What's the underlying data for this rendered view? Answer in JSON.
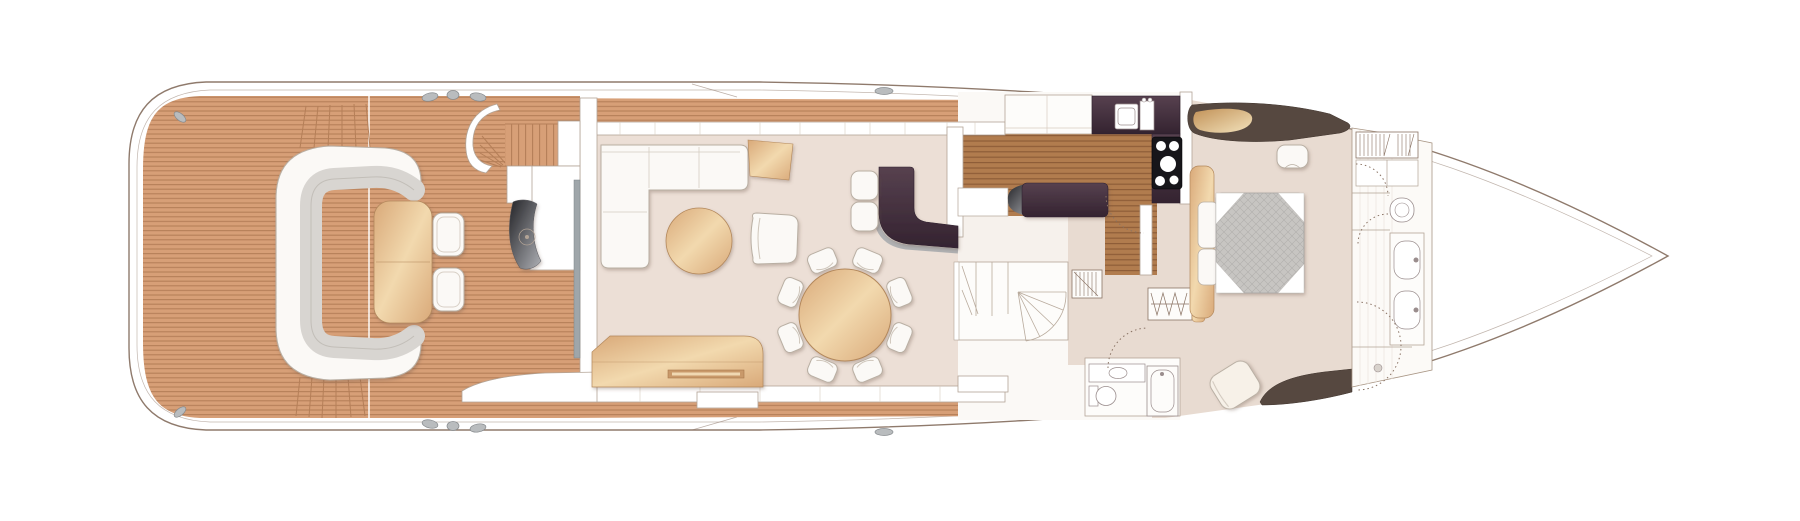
{
  "deck": {
    "plan_label": "main-deck-floor-plan",
    "areas": [
      {
        "id": "aft-cockpit",
        "features": [
          "teak-sole",
          "curved-sofa",
          "drinks-table",
          "two-stools",
          "flybridge-stairs",
          "side-boarding-steps",
          "deck-seam"
        ]
      },
      {
        "id": "saloon",
        "features": [
          "l-shaped-sofa",
          "corner-end-table",
          "round-coffee-table",
          "armchair",
          "round-dining-table",
          "eight-dining-chairs",
          "sideboard",
          "wet-bar",
          "two-bar-stools",
          "sliding-glass-door"
        ]
      },
      {
        "id": "galley",
        "features": [
          "upper-cabinets",
          "sink",
          "taps",
          "four-burner-hob",
          "aubergine-worktop",
          "island-unit",
          "timber-sole"
        ]
      },
      {
        "id": "midship-lobby",
        "features": [
          "companionway-stairs",
          "spiral-steps",
          "hanging-locker",
          "wardrobe",
          "timber-bench"
        ]
      },
      {
        "id": "day-head",
        "features": [
          "wc",
          "vanity-basin",
          "bathtub"
        ]
      },
      {
        "id": "forward-cabin",
        "features": [
          "double-bed",
          "quilted-mattress",
          "headboard",
          "bedside-units",
          "dresser-unit",
          "vanity-stool",
          "reading-chair",
          "hull-side-settee"
        ]
      },
      {
        "id": "forward-bathroom",
        "features": [
          "hanging-locker",
          "storage-cabinets",
          "wc",
          "twin-basin-vanity",
          "shower",
          "floor-drain"
        ]
      },
      {
        "id": "foredeck",
        "features": [
          "hull-outline"
        ]
      }
    ]
  },
  "colors": {
    "hull_line": "#8f7a6c",
    "teak": "#d79f77",
    "teak_caulk": "#b57f58",
    "galley_sole": "#b17c4e",
    "galley_caulk": "#8d5d38",
    "saloon_floor": "#ecdfd6",
    "cabin_floor": "#e8dbd1",
    "aubergine": "#57414f",
    "aubergine_dark": "#342330",
    "dark_trim": "#564840",
    "wood": "#d9a979",
    "wood_light": "#f2d9ae",
    "wood_edge": "#b3885c",
    "upholstery": "#fbf9f6",
    "upholstery_edge": "#b9afa3",
    "cushion": "#d8d5d1",
    "mattress": "#c7c5c2",
    "mattress_line": "#b1afad",
    "wall_fill": "#ffffff",
    "wall_edge": "#b3a496",
    "fixture_edge": "#9a8d8d",
    "fitting": "#b9bcbe",
    "fitting_edge": "#868a8d",
    "glass": "#9fa6aa",
    "metal_dark": "#232327",
    "metal_light": "#aeb0b5",
    "gold": "#c29258",
    "gold_light": "#f2e2bc",
    "door_arc": "#8a7364"
  }
}
